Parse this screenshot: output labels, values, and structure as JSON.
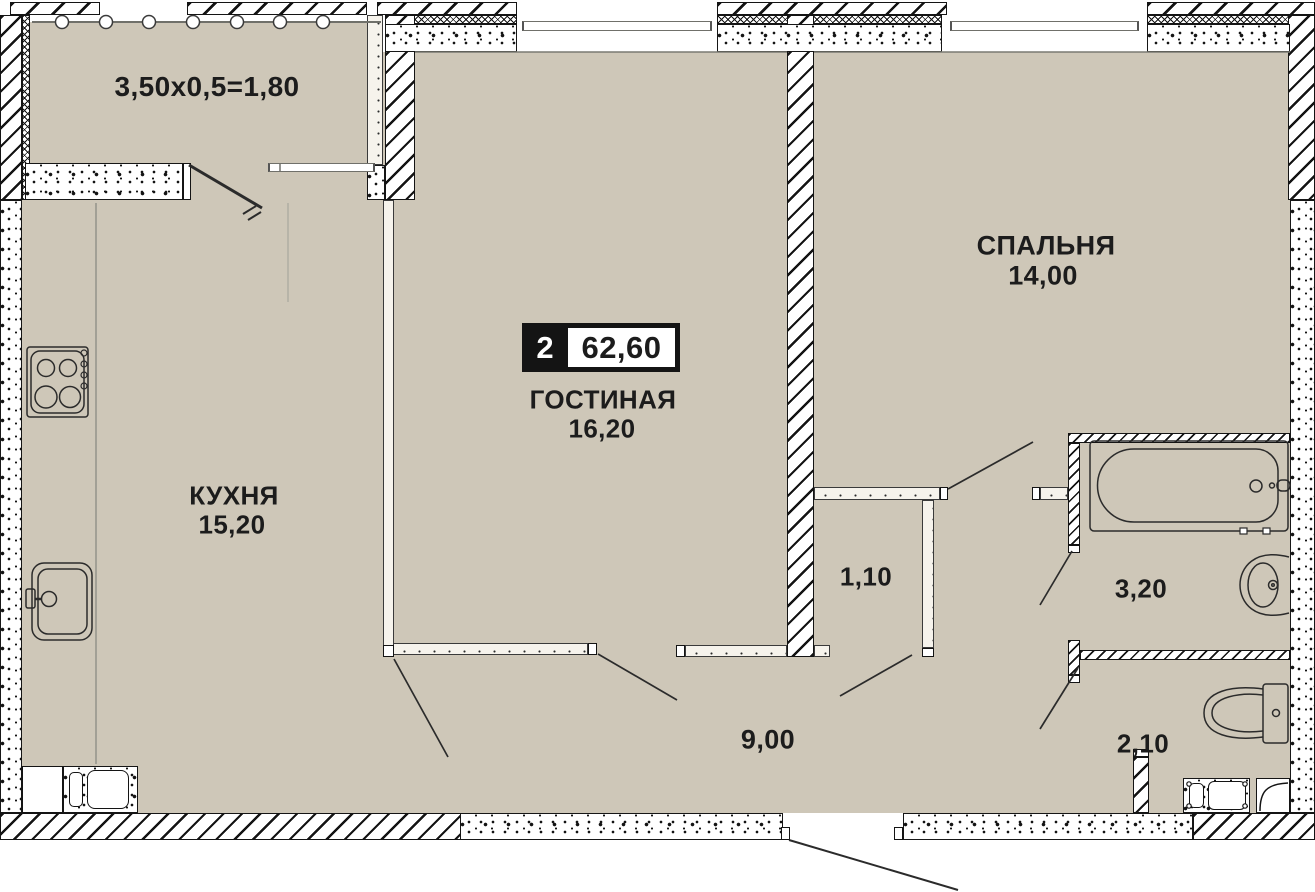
{
  "plan": {
    "type_badge": {
      "rooms_count": "2",
      "total_area": "62,60"
    },
    "balcony": {
      "dimension_formula": "3,50x0,5=1,80"
    },
    "rooms": {
      "living": {
        "name": "ГОСТИНАЯ",
        "area": "16,20"
      },
      "bedroom": {
        "name": "СПАЛЬНЯ",
        "area": "14,00"
      },
      "kitchen": {
        "name": "КУХНЯ",
        "area": "15,20"
      },
      "hallway": {
        "area": "9,00"
      },
      "wardrobe": {
        "area": "1,10"
      },
      "bathroom": {
        "area": "3,20"
      },
      "wc": {
        "area": "2,10"
      }
    },
    "colors": {
      "floor": "#cec7b8",
      "ink": "#1c1c1c",
      "badge": "#141414"
    }
  }
}
